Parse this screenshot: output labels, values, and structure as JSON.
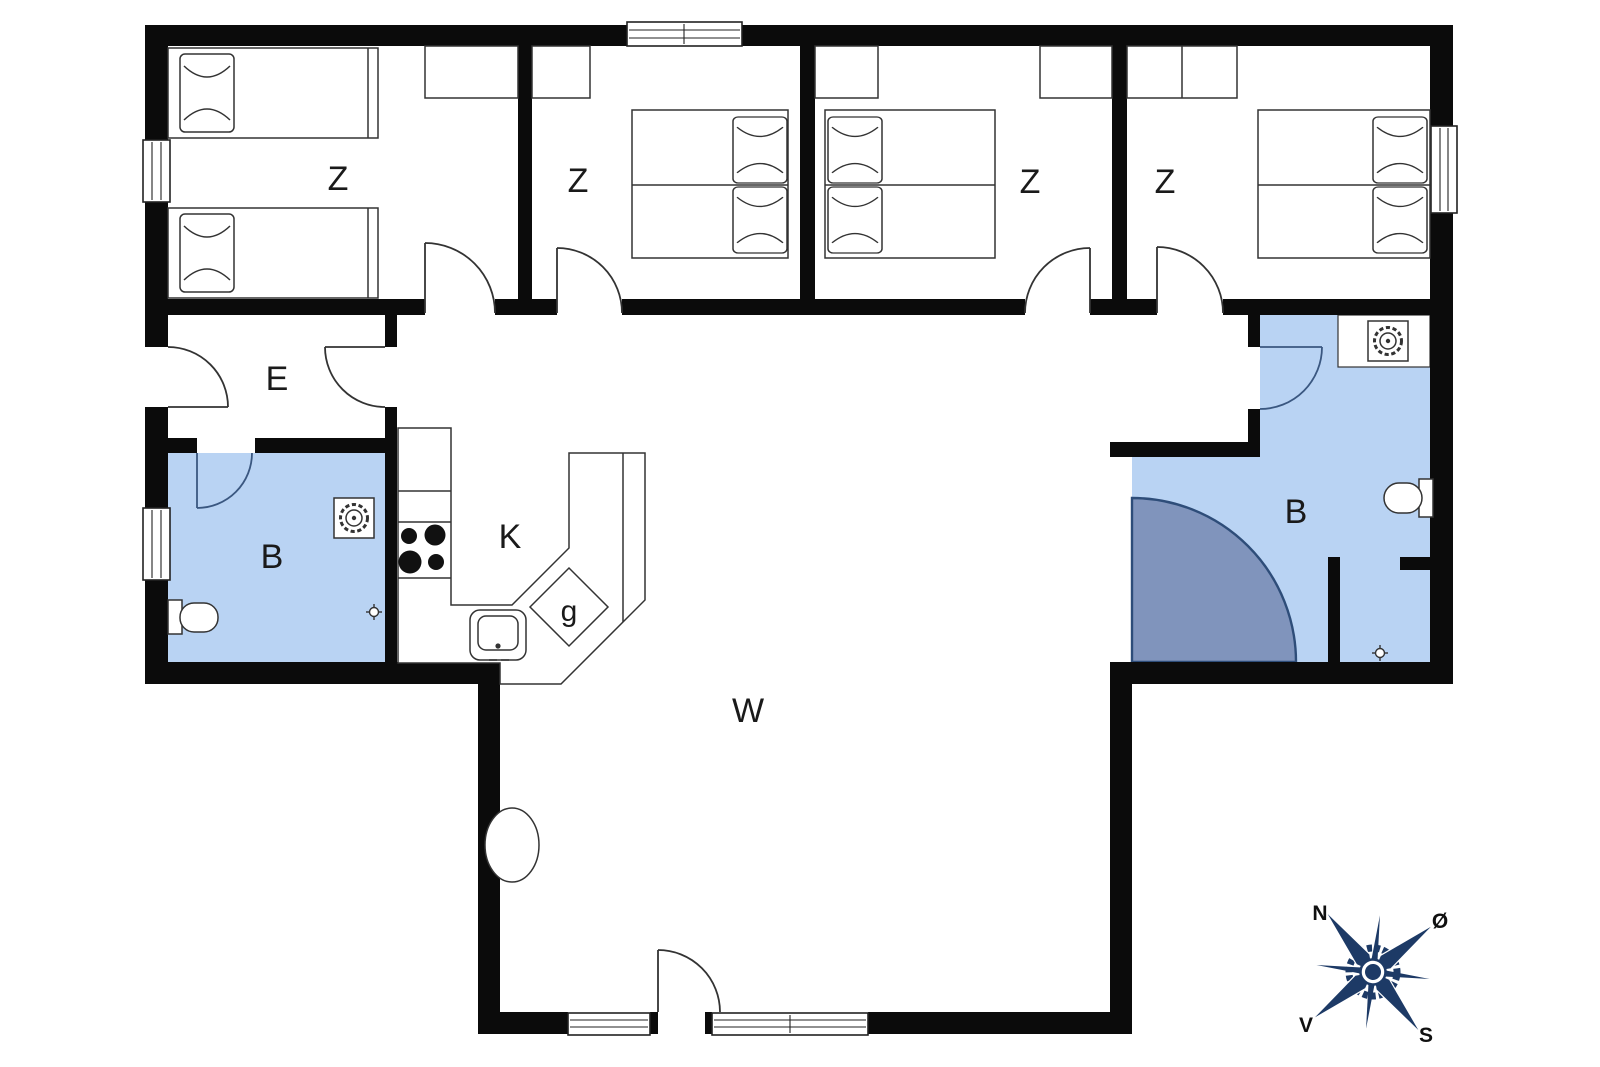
{
  "rooms": [
    {
      "id": "bedroom-1",
      "label": "Z"
    },
    {
      "id": "bedroom-2",
      "label": "Z"
    },
    {
      "id": "bedroom-3",
      "label": "Z"
    },
    {
      "id": "bedroom-4",
      "label": "Z"
    },
    {
      "id": "entrance",
      "label": "E"
    },
    {
      "id": "bathroom-left",
      "label": "B"
    },
    {
      "id": "kitchen",
      "label": "K"
    },
    {
      "id": "hob-corner",
      "label": "g"
    },
    {
      "id": "bathroom-right",
      "label": "B"
    },
    {
      "id": "living-room",
      "label": "W"
    }
  ],
  "compass": {
    "north": "N",
    "east": "Ø",
    "south": "S",
    "west": "V"
  },
  "colors": {
    "wall": "#0b0b0b",
    "line": "#333333",
    "bathroom_fill": "#b9d3f3",
    "shower_fill": "#8094bc",
    "shower_edge": "#2e4d79",
    "compass": "#1d3a66",
    "door_bath": "#3a5780"
  }
}
